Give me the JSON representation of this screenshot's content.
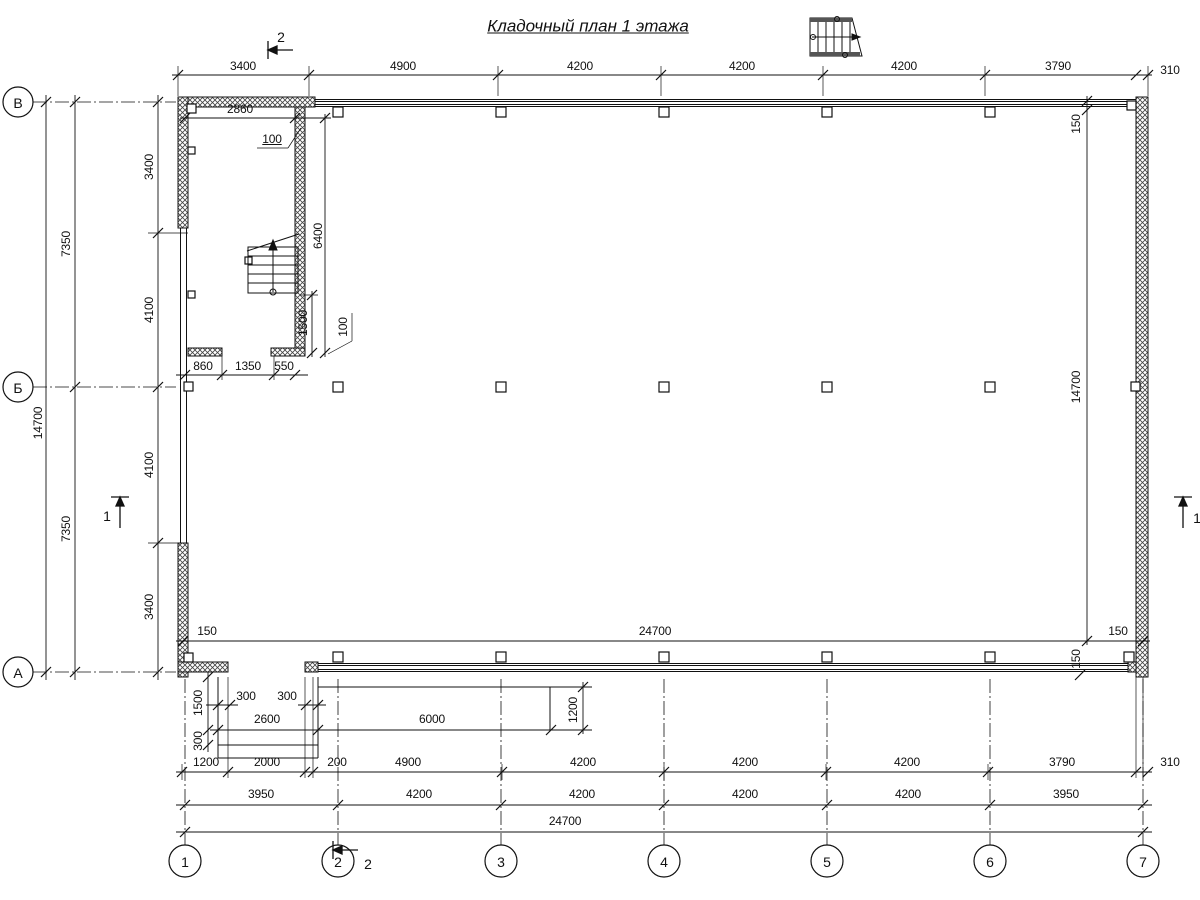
{
  "title": "Кладочный план 1 этажа",
  "grid": {
    "rows": [
      "В",
      "Б",
      "А"
    ],
    "cols": [
      "1",
      "2",
      "3",
      "4",
      "5",
      "6",
      "7"
    ]
  },
  "sections": {
    "top": "2",
    "bottom": "2",
    "left": "1",
    "right": "1"
  },
  "dims": {
    "top": [
      "3400",
      "4900",
      "4200",
      "4200",
      "4200",
      "3790",
      "310"
    ],
    "row1": [
      "1200",
      "2000",
      "200",
      "4900",
      "4200",
      "4200",
      "4200",
      "3790",
      "310"
    ],
    "row2": [
      "3950",
      "4200",
      "4200",
      "4200",
      "4200",
      "3950"
    ],
    "total_w": "24700",
    "left_seg": [
      "3400",
      "4100",
      "4100",
      "3400"
    ],
    "left_half": [
      "7350",
      "7350"
    ],
    "total_h": "14700",
    "inner": {
      "l150": "150",
      "w24700": "24700",
      "r150": "150",
      "rt150": "150",
      "r14700": "14700",
      "rb150": "150"
    },
    "room": {
      "w2860": "2860",
      "lead100a": "100",
      "h6400": "6400",
      "w1500": "1500",
      "lead100b": "100",
      "b860": "860",
      "b1350": "1350",
      "b550": "550"
    },
    "porch": {
      "s300a": "300",
      "s300b": "300",
      "w2600": "2600",
      "w6000": "6000",
      "d1200": "1200",
      "d1500": "1500",
      "d300": "300"
    }
  }
}
